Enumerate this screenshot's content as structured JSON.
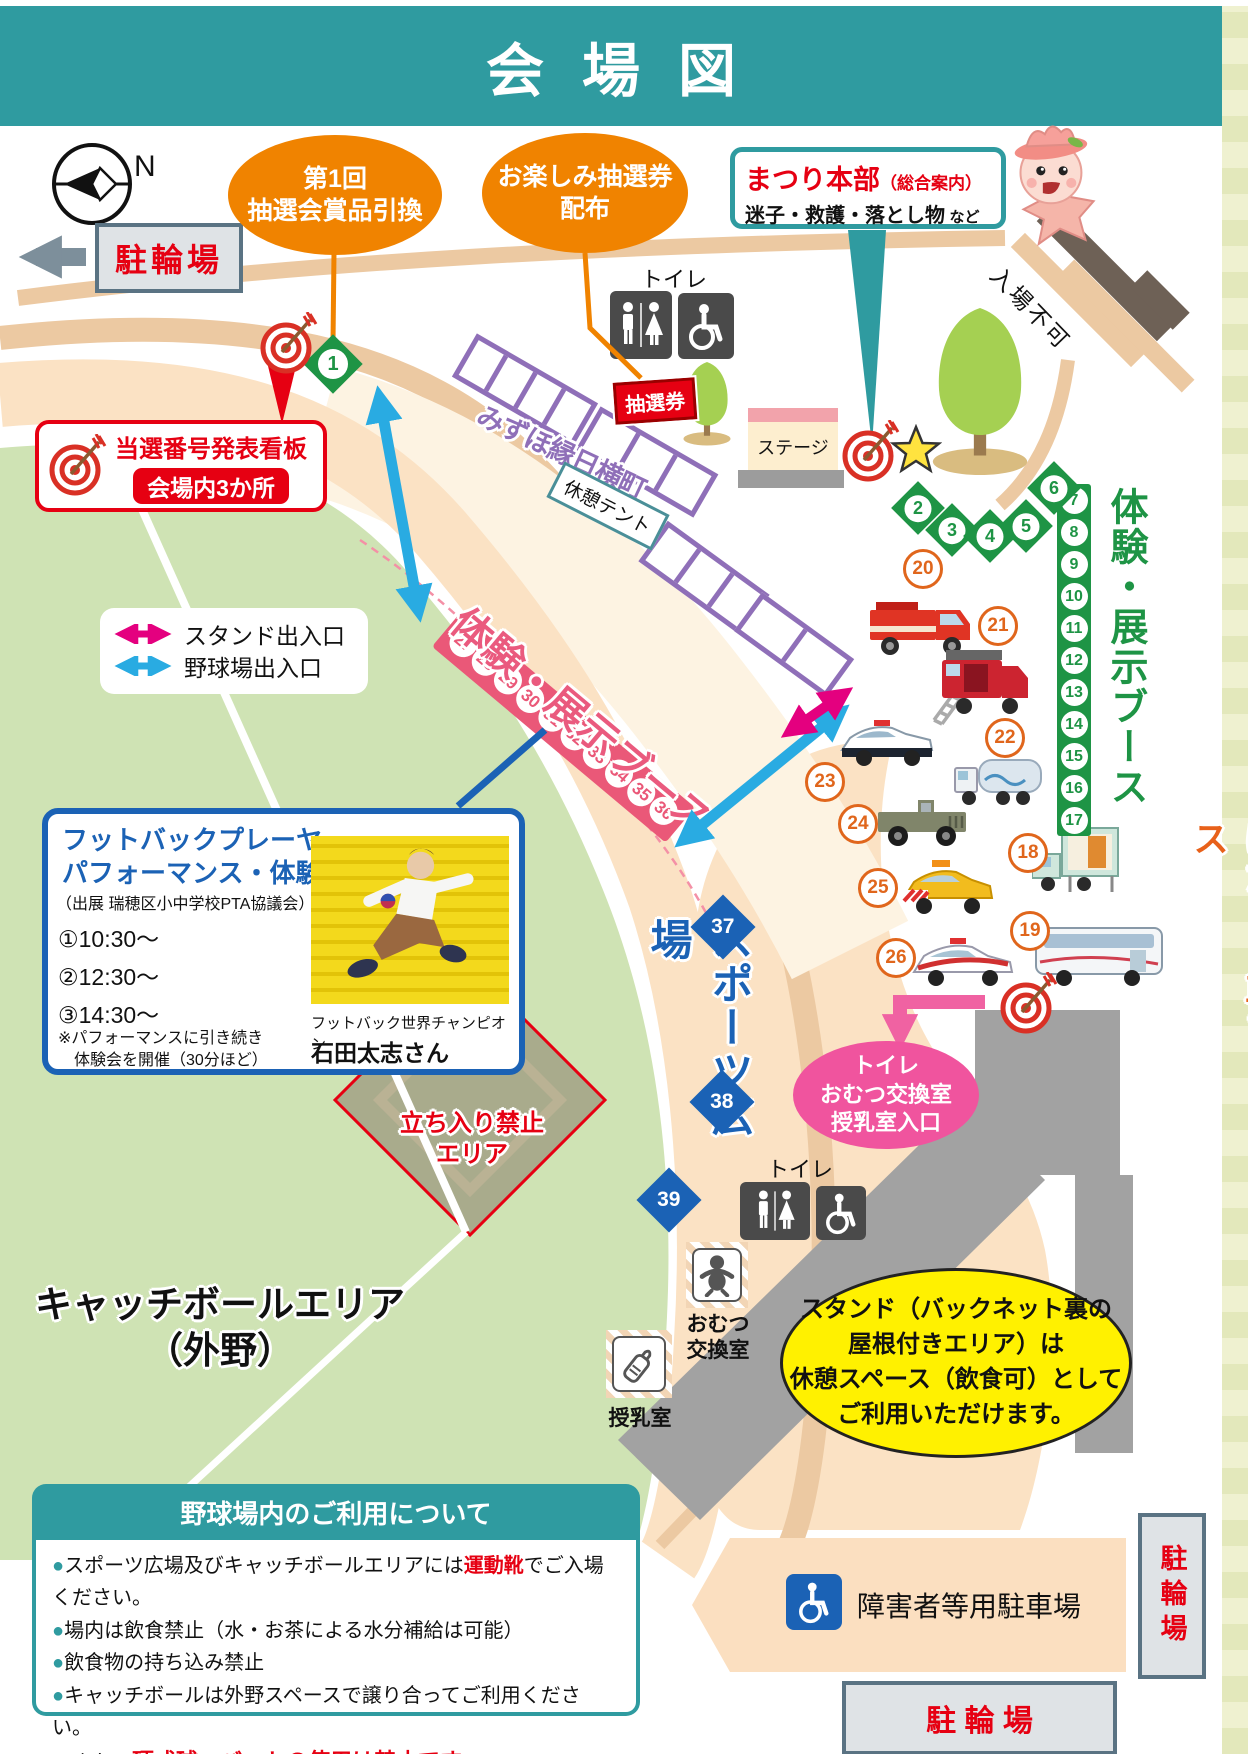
{
  "page": {
    "title": "会場図"
  },
  "compass": {
    "label": "N"
  },
  "parking": {
    "top_left": "駐輪場",
    "right_vertical": "駐輪場",
    "bottom": "駐 輪 場",
    "disabled": "障害者等用駐車場"
  },
  "balloons": {
    "prize_line1": "第1回",
    "prize_line2": "抽選会賞品引換",
    "ticket_line1": "お楽しみ抽選券",
    "ticket_line2": "配布"
  },
  "headquarters": {
    "title": "まつり本部",
    "subtitle": "（総合案内）",
    "desc": "迷子・救護・落とし物",
    "desc_suffix": "など"
  },
  "labels": {
    "no_entry": "入場不可",
    "toilet_top": "トイレ",
    "toilet_bottom": "トイレ",
    "lottery_ticket": "抽選券",
    "stage": "ステージ",
    "street": "みずほ縁日横町",
    "rest_tent": "休憩テント",
    "booth_pink": "体験・展示ブース",
    "booth_green": "体験・展示ブース",
    "working_vehicles": "はたらく車ブース",
    "sports_plaza": "スポーツ広場",
    "keep_out_line1": "立ち入り禁止",
    "keep_out_line2": "エリア",
    "catch_line1": "キャッチボールエリア",
    "catch_line2": "（外野）",
    "diaper_line1": "おむつ",
    "diaper_line2": "交換室",
    "nursing": "授乳室"
  },
  "winning_board": {
    "title": "当選番号発表看板",
    "badge": "会場内3か所"
  },
  "legend": {
    "stand": "スタンド出入口",
    "ballpark": "野球場出入口"
  },
  "footbag": {
    "title1": "フットバックプレーヤー",
    "title2": "パフォーマンス・体験会",
    "exhibitor": "（出展 瑞穂区小中学校PTA協議会）",
    "time1": "①10:30～",
    "time2": "②12:30～",
    "time3": "③14:30～",
    "note1": "※パフォーマンスに引き続き",
    "note2": "　体験会を開催（30分ほど）",
    "champion_title": "フットバック世界チャンピオン",
    "champion_name": "石田太志さん"
  },
  "pink_oval": {
    "line1": "トイレ",
    "line2": "おむつ交換室",
    "line3": "授乳室入口"
  },
  "stand_notice": {
    "line1": "スタンド（バックネット裏の",
    "line2": "屋根付きエリア）は",
    "line3": "休憩スペース（飲食可）として",
    "line4": "ご利用いただけます。"
  },
  "rules": {
    "title": "野球場内のご利用について",
    "item1": {
      "pre": "スポーツ広場及びキャッチボールエリアには",
      "red": "運動靴",
      "post": "でご入場ください。"
    },
    "item2": {
      "pre": "場内は飲食禁止（水・お茶による水分補給は可能）"
    },
    "item3": {
      "pre": "飲食物の持ち込み禁止"
    },
    "item4": {
      "pre": "キャッチボールは外野スペースで譲り合ってご利用ください。"
    },
    "item4b": {
      "pre": "また、",
      "red": "硬式球・バットの使用は禁止です",
      "post": "。"
    }
  },
  "numbers": {
    "spot1": "1",
    "tree_arc": [
      "2",
      "3",
      "4",
      "5",
      "6"
    ],
    "green_strip": [
      "7",
      "8",
      "9",
      "10",
      "11",
      "12",
      "13",
      "14",
      "15",
      "16",
      "17"
    ],
    "pink_strip": [
      "27",
      "28",
      "29",
      "30",
      "31",
      "32",
      "33",
      "34",
      "35",
      "36"
    ],
    "blue_diamonds": [
      "37",
      "38",
      "39"
    ]
  },
  "vehicles": [
    {
      "no": "18",
      "name": "exhibit-truck"
    },
    {
      "no": "19",
      "name": "city-bus"
    },
    {
      "no": "20",
      "name": "fire-truck"
    },
    {
      "no": "21",
      "name": "fire-support-truck"
    },
    {
      "no": "22",
      "name": "tank-truck"
    },
    {
      "no": "23",
      "name": "police-car"
    },
    {
      "no": "24",
      "name": "self-defense-jeep"
    },
    {
      "no": "25",
      "name": "road-patrol-car"
    },
    {
      "no": "26",
      "name": "patrol-suv"
    }
  ],
  "colors": {
    "teal": "#2f9ba0",
    "orange": "#f08300",
    "red": "#e60012",
    "pink_strip": "#ea5878",
    "green": "#1e9445",
    "blue": "#1b62b5",
    "purple": "#8f6fb8",
    "arrow_blue": "#29abe2",
    "arrow_pink": "#e4007f",
    "field_green": "#cfe3b4",
    "concourse": "#fbe2c4",
    "stand_tan": "#ecc9a2",
    "infield": "#a9ab8c",
    "yellow": "#fff100"
  }
}
